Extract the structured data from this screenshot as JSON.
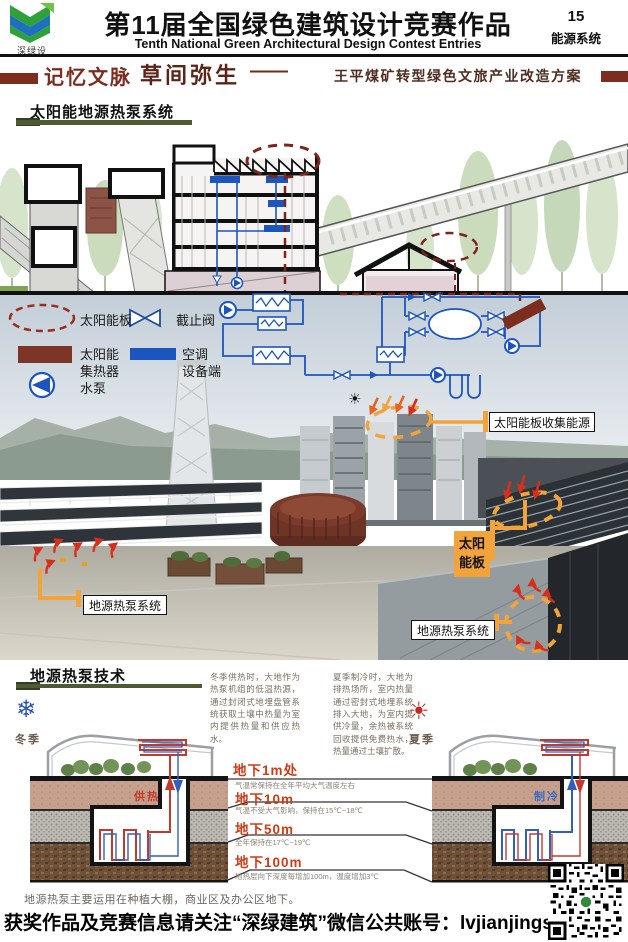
{
  "header": {
    "logo_text": "深绿设",
    "title_cn": "第11届全国绿色建筑设计竞赛作品",
    "title_en": "Tenth National Green Architectural Design Contest Entries",
    "entry_number": "15",
    "entry_category": "能源系统"
  },
  "banner": {
    "tag": "记忆文脉",
    "title": "草间弥生",
    "dash": "——",
    "subtitle": "王平煤矿转型绿色文旅产业改造方案"
  },
  "section1": {
    "title": "太阳能地源热泵系统"
  },
  "legend": {
    "solar_panel": "太阳能板",
    "stop_valve": "截止阀",
    "collector_l1": "太阳能",
    "collector_l2": "集热器",
    "ac_l1": "空调",
    "ac_l2": "设备端",
    "pump": "水泵"
  },
  "callouts": {
    "collect": "太阳能板收集能源",
    "panel_l1": "太阳",
    "panel_l2": "能板",
    "ghp_left": "地源热泵系统",
    "ghp_right": "地源热泵系统"
  },
  "section2": {
    "title": "地源热泵技术"
  },
  "tech": {
    "winter_label": "冬季",
    "summer_label": "夏季",
    "winter_text": "冬季供热时，大地作为热泵机组的低温热源，通过封闭式地埋盘管系统获取土壤中热量为室内提供热量和供应热水。",
    "summer_text": "夏季制冷时，大地为排热场所，室内热量通过密封式地埋系统排入大地，为室内提供冷量，余热被系统回收提供免费热水，热量通过土壤扩散。",
    "heating": "供热",
    "cooling": "制冷",
    "depths": [
      {
        "title": "地下1m处",
        "desc": "气温常保持在全年平均大气温度左右"
      },
      {
        "title": "地下10m",
        "desc": "气温不受大气影响，保持在15℃~18℃"
      },
      {
        "title": "地下50m",
        "desc": "全年保持在17℃~19℃"
      },
      {
        "title": "地下100m",
        "desc": "地热层向下深度每增加100m，温度增加3℃"
      }
    ],
    "note": "地源热泵主要运用在种植大棚，商业区及办公区地下。"
  },
  "footer": {
    "text": "获奖作品及竞赛信息请关注“深绿建筑”微信公共账号：lvjianjingsai"
  },
  "icons": {
    "snowflake": "❄",
    "sun": "☀",
    "sun_small": "☀"
  },
  "colors": {
    "maroon": "#7c2d1e",
    "accent_orange": "#f2a33c",
    "schematic_blue": "#1d55be",
    "olive_underline": "#4d5a33",
    "depth_red": "#d03b16"
  }
}
